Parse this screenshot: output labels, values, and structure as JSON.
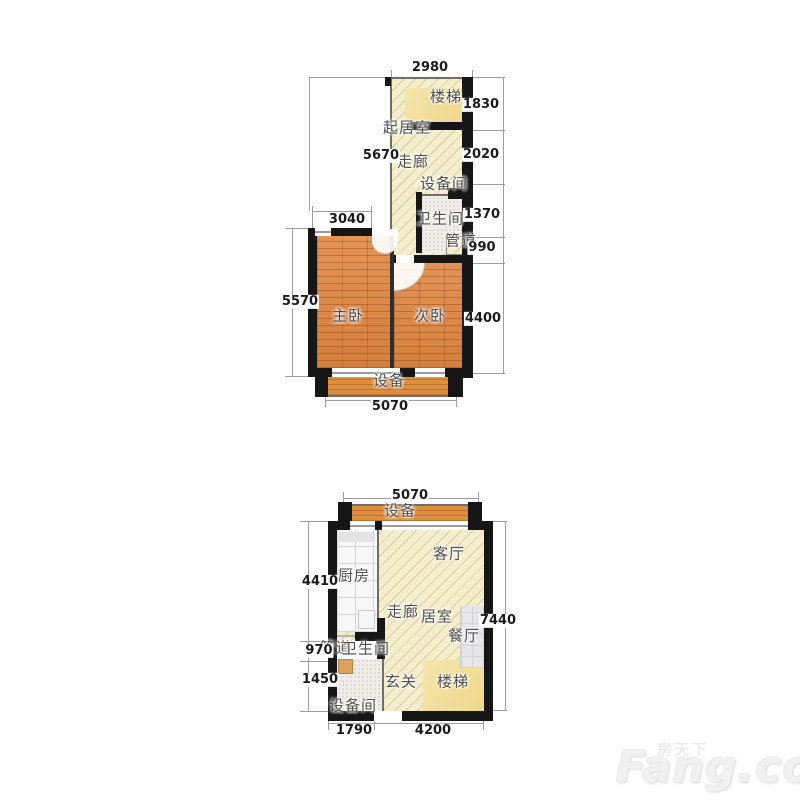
{
  "upper_plan": {
    "rooms": {
      "stairs": "楼梯",
      "living_room": "起居室",
      "corridor": "走廊",
      "equipment_room": "设备间",
      "bathroom": "卫生间",
      "pipe_duct": "管道",
      "master_bedroom": "主卧",
      "second_bedroom": "次卧",
      "equipment_balcony": "设备"
    },
    "dimensions_mm": {
      "top_width": "2980",
      "stairs_height": "1830",
      "corridor_height": "2020",
      "bathroom_height": "1370",
      "pipe_height": "990",
      "bedroom_zone_height": "4400",
      "left_height": "5670",
      "master_width": "3040",
      "bedrooms_height": "5570",
      "bottom_width": "5070"
    }
  },
  "lower_plan": {
    "rooms": {
      "equipment_balcony": "设备",
      "kitchen": "厨房",
      "living_room": "客厅",
      "corridor": "走廊",
      "room": "居室",
      "dining_room": "餐厅",
      "pipe_duct": "管道",
      "bathroom": "卫生间",
      "entrance_hall": "玄关",
      "stairs": "楼梯",
      "equipment_room": "设备间"
    },
    "dimensions_mm": {
      "top_width": "5070",
      "kitchen_height": "4410",
      "passage_height": "970",
      "bathroom_height": "1450",
      "right_height": "7440",
      "bottom_left_width": "1790",
      "bottom_right_width": "4200"
    }
  },
  "watermark": {
    "brand_cn": "房天下",
    "brand_en": "Fang.com"
  }
}
